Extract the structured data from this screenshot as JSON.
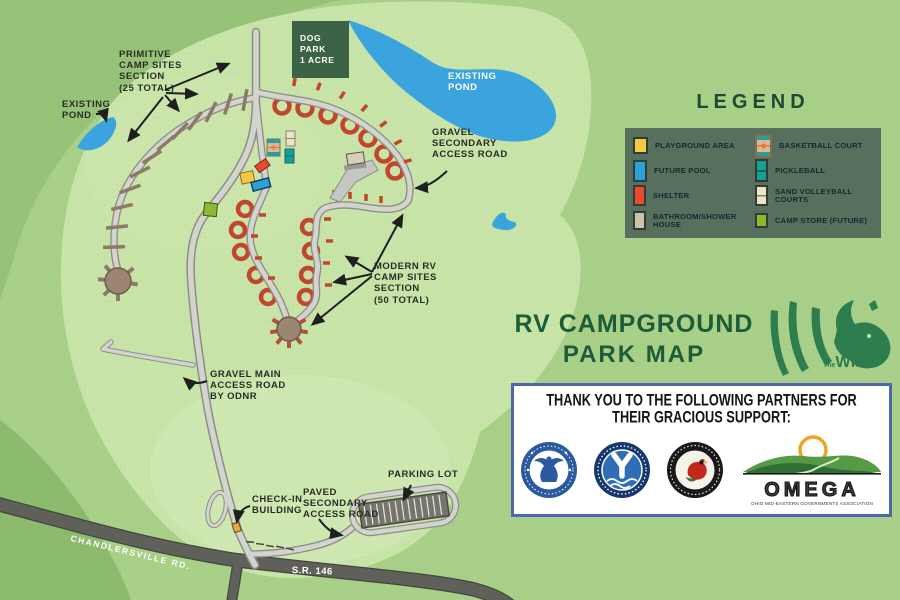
{
  "title": {
    "line1": "RV CAMPGROUND",
    "line2": "PARK MAP"
  },
  "wilds_logo": {
    "prefix": "The",
    "name": "Wilds"
  },
  "legend": {
    "title": "LEGEND",
    "items": [
      {
        "label": "PLAYGROUND AREA",
        "color": "#f7c844"
      },
      {
        "label": "FUTURE POOL",
        "color": "#2da0d8"
      },
      {
        "label": "SHELTER",
        "color": "#e8492f"
      },
      {
        "label": "BATHROOM/SHOWER HOUSE",
        "color": "#cec2a9"
      },
      {
        "label": "BASKETBALL COURT",
        "color": "#d9b894"
      },
      {
        "label": "PICKLEBALL",
        "color": "#17a096"
      },
      {
        "label": "SAND VOLLEYBALL COURTS",
        "color": "#ece3cb"
      },
      {
        "label": "CAMP STORE (FUTURE)",
        "color": "#8cb832"
      }
    ]
  },
  "map": {
    "labels": {
      "primitive_sites": "PRIMITIVE\nCAMP SITES\nSECTION\n(25 TOTAL)",
      "existing_pond_left": "EXISTING\nPOND",
      "existing_pond_right": "EXISTING\nPOND",
      "dog_park": "DOG PARK\n1 ACRE",
      "gravel_secondary": "GRAVEL\nSECONDARY\nACCESS ROAD",
      "modern_rv_sites": "MODERN RV\nCAMP SITES\nSECTION\n(50 TOTAL)",
      "gravel_main": "GRAVEL MAIN\nACCESS ROAD\nBY ODNR",
      "check_in": "CHECK-IN\nBUILDING",
      "paved_secondary": "PAVED\nSECONDARY\nACCESS ROAD",
      "parking_lot": "PARKING LOT",
      "chandlersville_rd": "CHANDLERSVILLE RD.",
      "sr_146": "S.R. 146"
    },
    "icons": [
      "playground-area",
      "future-pool",
      "shelter",
      "bathroom-shower-house",
      "basketball-court",
      "pickleball",
      "sand-volleyball-courts",
      "camp-store",
      "check-in-building",
      "parking-lot",
      "dog-park",
      "pond"
    ]
  },
  "partners": {
    "heading_line1": "THANK YOU TO THE FOLLOWING PARTNERS FOR",
    "heading_line2": "THEIR GRACIOUS SUPPORT:",
    "logos": [
      "us-department-of-commerce-eda-seal",
      "muskingum-county-water-department-seal",
      "ohio-department-of-natural-resources-seal",
      "omega-logo"
    ],
    "omega_name": "OMEGA",
    "omega_subtext": "OHIO MID-EASTERN GOVERNMENTS ASSOCIATION"
  },
  "colors": {
    "background_green": "#a9d089",
    "park_light_green": "#c8e4a8",
    "dark_green_edge": "#97c379",
    "pond_blue": "#3ba4de",
    "road_light": "#d4d4ce",
    "road_casing": "#8e8e87",
    "highway_gray": "#60605b",
    "rv_site_red": "#c2462e",
    "primitive_site_brown": "#8a7b65",
    "loop_circle_brown": "#9b8472",
    "dog_park_green": "#3c6345",
    "legend_panel_green": "#57705d",
    "title_green": "#1d5c38",
    "partners_border_blue": "#4a67b0",
    "check_in_orange": "#eca53f"
  }
}
